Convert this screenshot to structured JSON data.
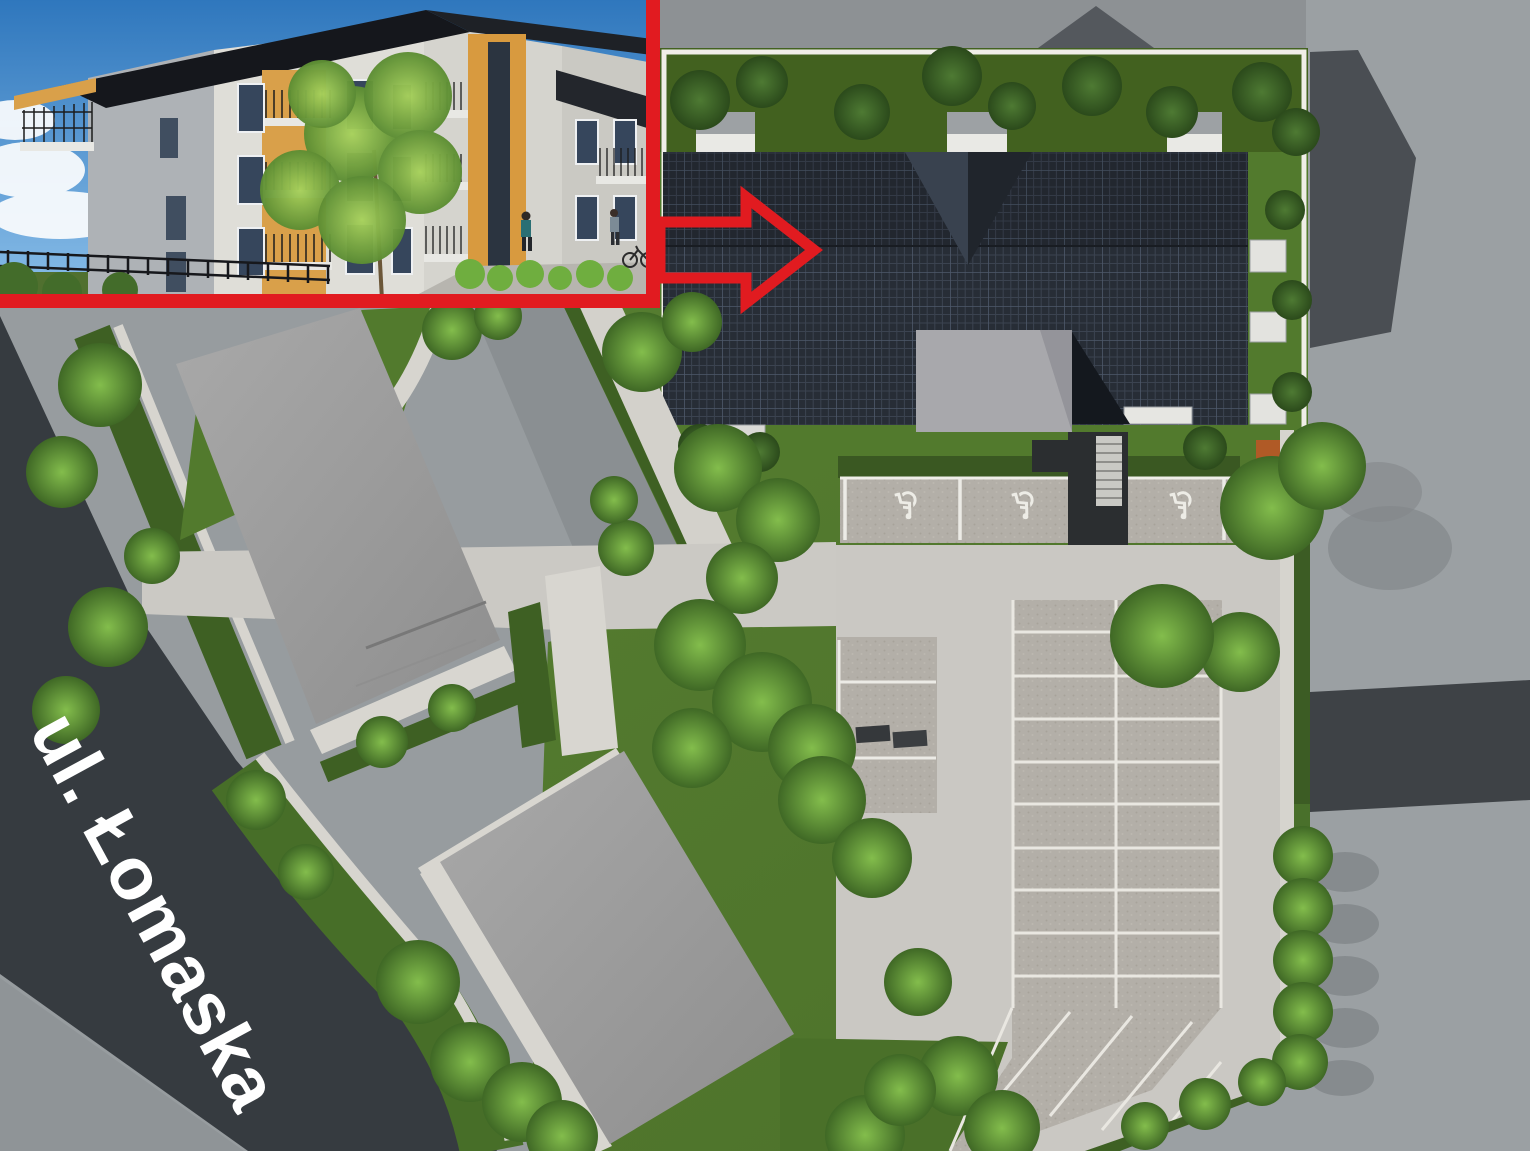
{
  "street_label": {
    "text": "ul. Łomaska"
  },
  "parking": {
    "accessible_icon": "♿",
    "accessible_spaces_count": 3,
    "main_lot_rows": 9,
    "main_lot_columns": 2
  },
  "annotation": {
    "arrow_icon": "arrow-right-outline",
    "arrow_color": "#e11b20"
  },
  "inset": {
    "border_color": "#e11b20"
  },
  "colors": {
    "road_dark": "#363b40",
    "pavement_gray": "#979c9f",
    "aisle_gray": "#cac8c3",
    "lawn_green": "#527a2d",
    "solar_roof": "#272d36",
    "plot_gray": "#9c9c9c",
    "sidewalk_light": "#d7d5cf",
    "accent_red": "#e11b20"
  }
}
